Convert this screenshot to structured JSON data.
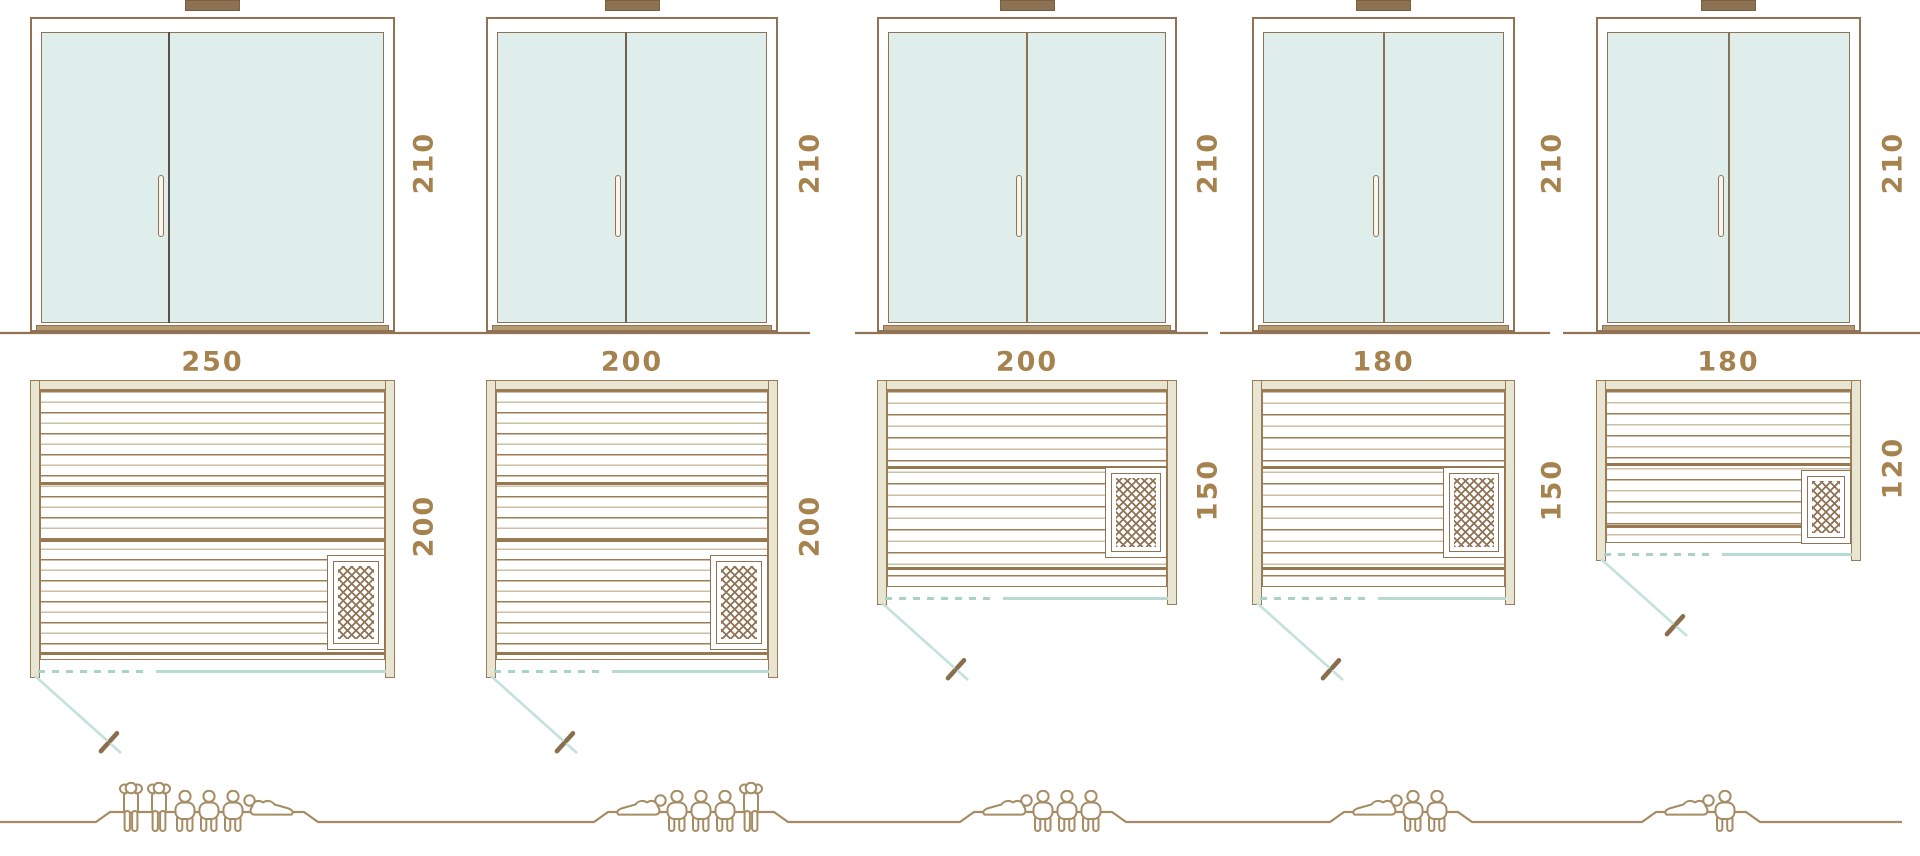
{
  "palette": {
    "outline_brown": "#8f7354",
    "slat_brown": "#9b7c55",
    "slat_light": "#cbbfa4",
    "label_gold": "#a5824e",
    "wall_beige": "#e8e5d3",
    "glass_blue": "#dfeeea",
    "door_swing_teal": "#b7dad2",
    "figure_tan": "#a58c64",
    "dark_divider": "#57514a"
  },
  "models": [
    {
      "id": "250x200",
      "height_label": "210",
      "width_label": "250",
      "depth_label": "200",
      "door_height_cm": 210,
      "width_cm": 250,
      "depth_cm": 200,
      "heater": "bottom-right-corner",
      "capacity_total": 6,
      "figures": [
        "standing",
        "standing",
        "sitting",
        "sitting",
        "sitting",
        "lying"
      ]
    },
    {
      "id": "200x200",
      "height_label": "210",
      "width_label": "200",
      "depth_label": "200",
      "door_height_cm": 210,
      "width_cm": 200,
      "depth_cm": 200,
      "heater": "bottom-right-corner",
      "capacity_total": 5,
      "figures": [
        "lying",
        "sitting",
        "sitting",
        "sitting",
        "standing"
      ]
    },
    {
      "id": "200x150",
      "height_label": "210",
      "width_label": "200",
      "depth_label": "150",
      "door_height_cm": 210,
      "width_cm": 200,
      "depth_cm": 150,
      "heater": "right-wall",
      "capacity_total": 4,
      "figures": [
        "lying",
        "sitting",
        "sitting",
        "sitting"
      ]
    },
    {
      "id": "180x150",
      "height_label": "210",
      "width_label": "180",
      "depth_label": "150",
      "door_height_cm": 210,
      "width_cm": 180,
      "depth_cm": 150,
      "heater": "right-wall",
      "capacity_total": 3,
      "figures": [
        "lying",
        "sitting",
        "sitting"
      ]
    },
    {
      "id": "180x120",
      "height_label": "210",
      "width_label": "180",
      "depth_label": "120",
      "door_height_cm": 210,
      "width_cm": 180,
      "depth_cm": 120,
      "heater": "right-wall",
      "capacity_total": 2,
      "figures": [
        "lying",
        "sitting"
      ]
    }
  ]
}
